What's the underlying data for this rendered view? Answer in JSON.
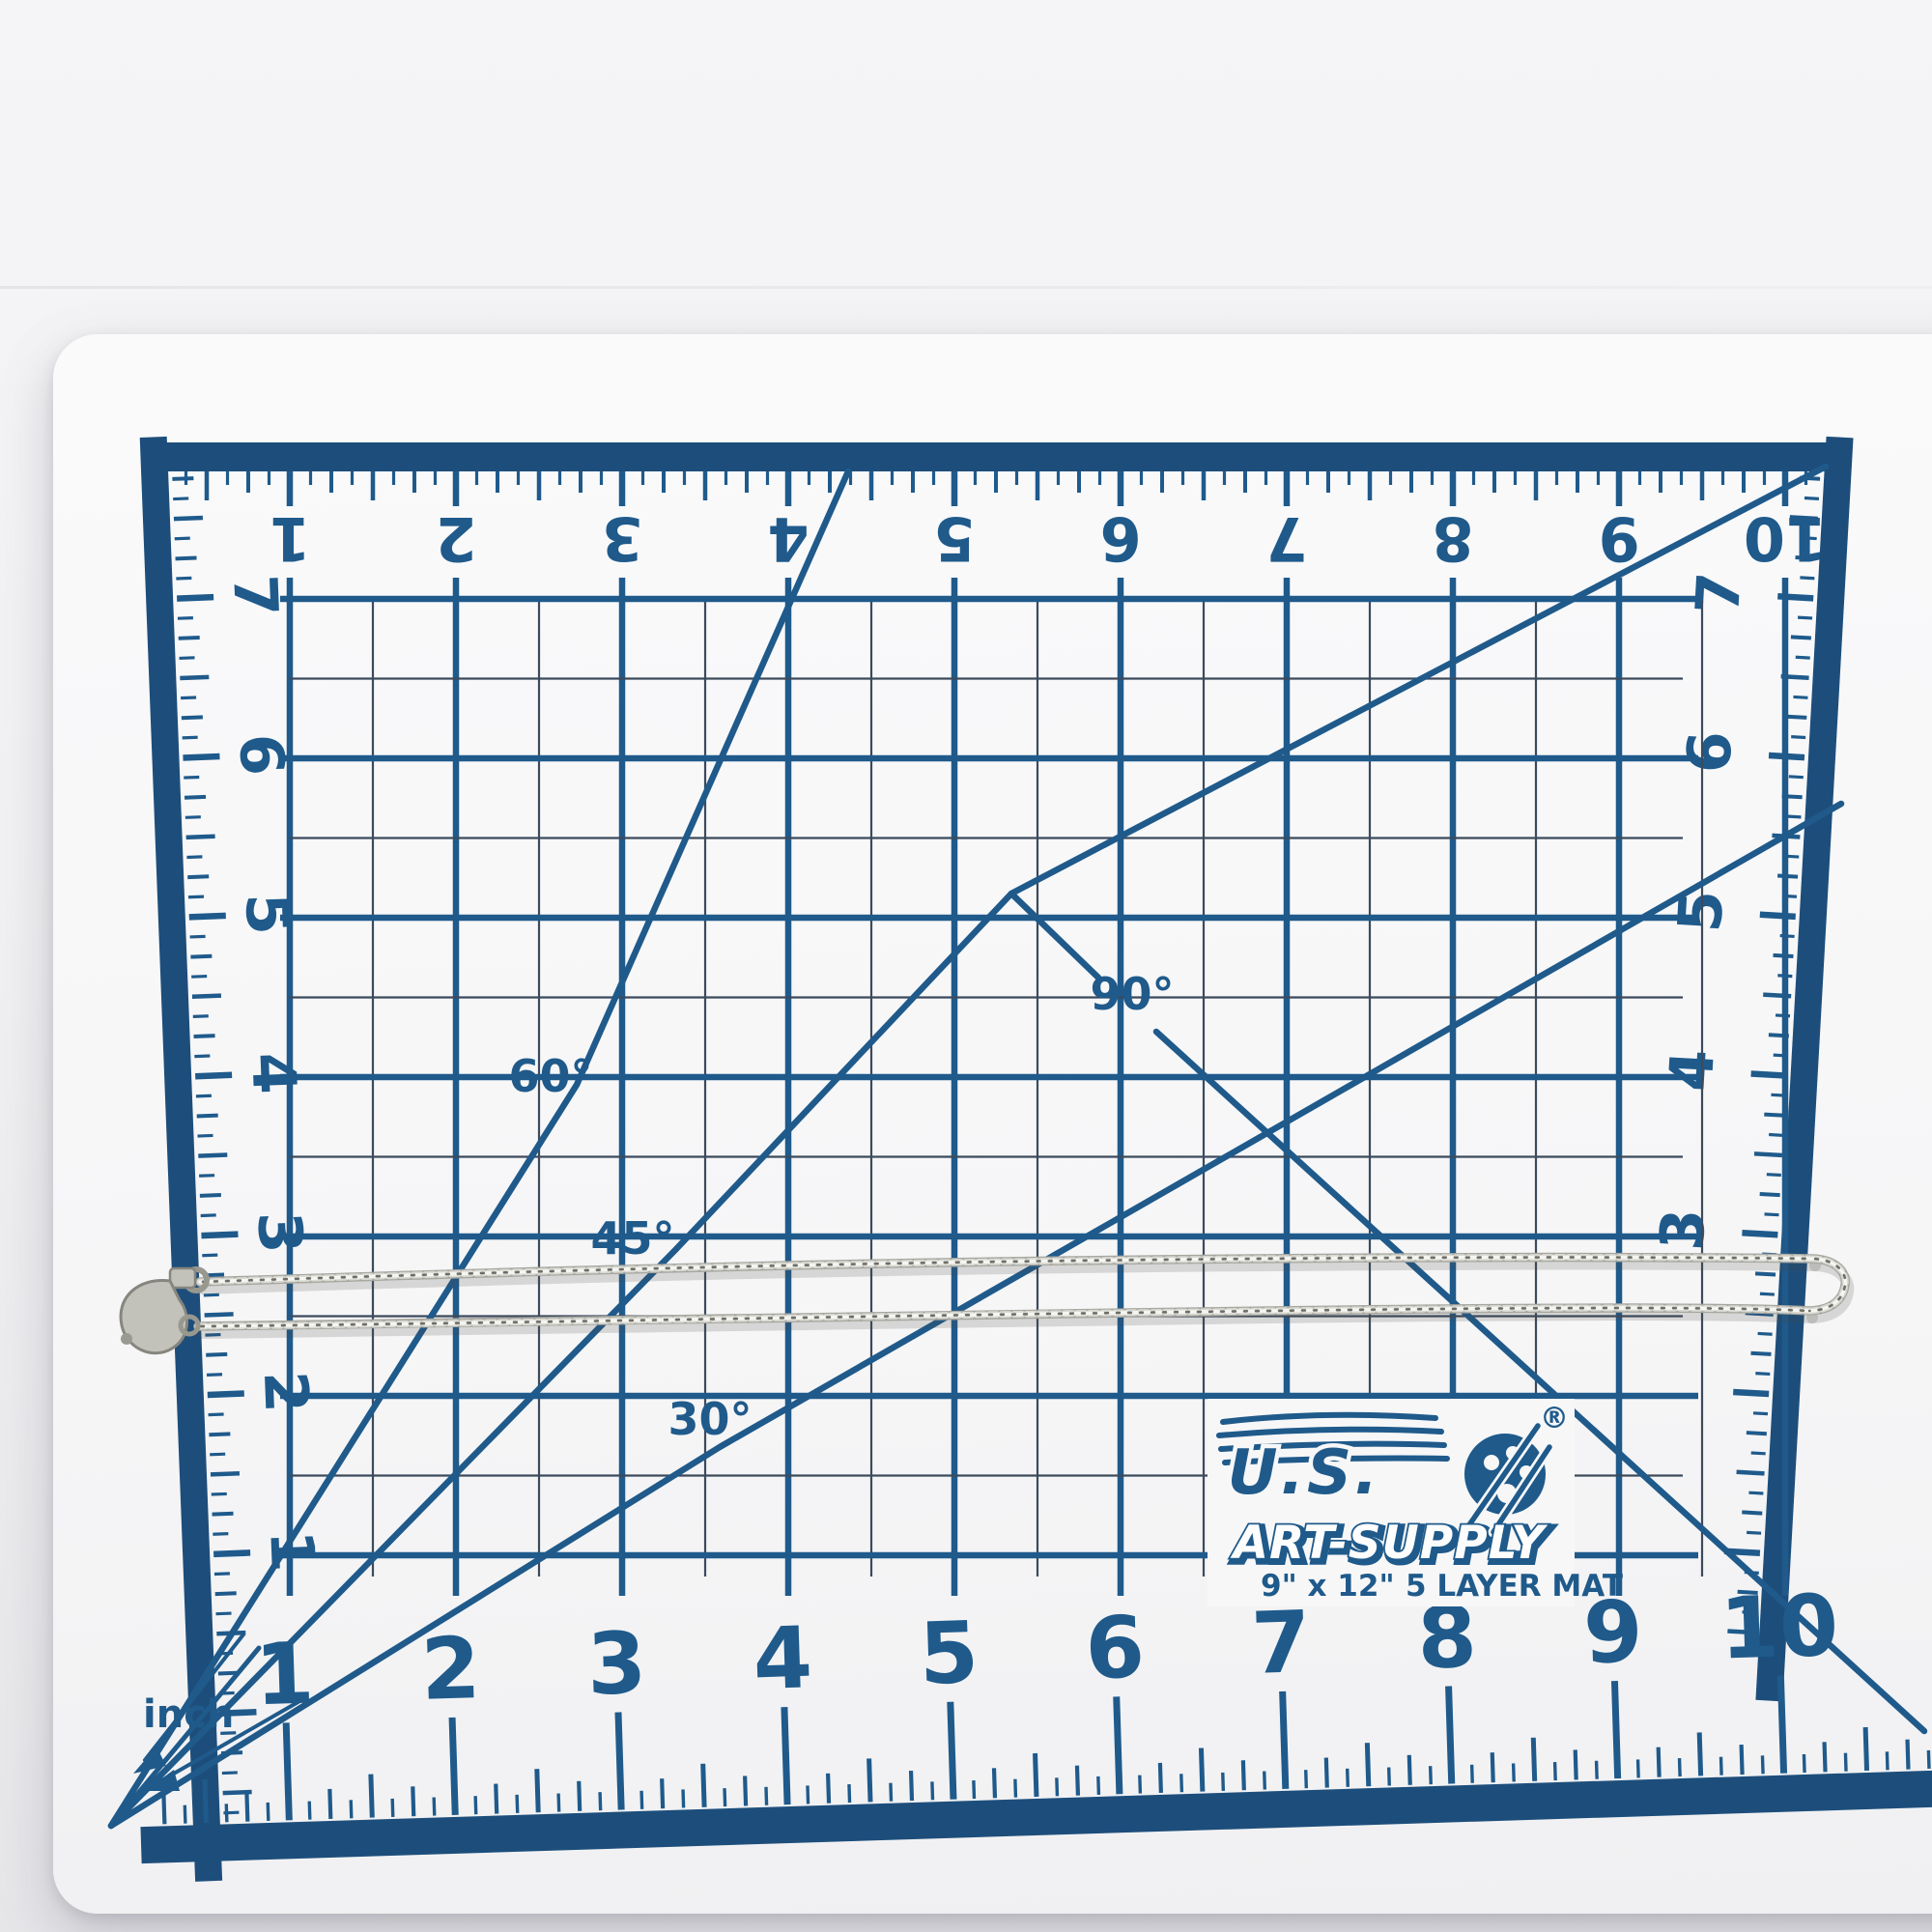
{
  "photo": {
    "backdrop_color": "#f1f1f3",
    "mat_surface_color": "#f7f7f8",
    "print_color": "#1f5a8b",
    "border_color": "#1d4e7b",
    "fine_line_color": "#3c4a5c"
  },
  "mat": {
    "unit_label": "inch",
    "angle_labels": [
      "90°",
      "60°",
      "45°",
      "30°"
    ],
    "ruler_numbers": {
      "top": [
        "1",
        "2",
        "3",
        "4",
        "5",
        "6",
        "7",
        "8",
        "9",
        "10"
      ],
      "bottom": [
        "1",
        "2",
        "3",
        "4",
        "5",
        "6",
        "7",
        "8",
        "9",
        "10"
      ],
      "left": [
        "7",
        "6",
        "5",
        "4",
        "3",
        "2",
        "1"
      ],
      "right": [
        "7",
        "6",
        "5",
        "4",
        "3"
      ]
    },
    "logo": {
      "brand_top": "U.S.",
      "brand_bottom": "ART-SUPPLY",
      "registered": "®",
      "size": "9\" x 12\"",
      "layers": "5 LAYER MAT"
    }
  },
  "chain": {
    "color_shadow": "rgba(70,70,64,0.18)",
    "color_base": "#a7a7a0",
    "color_mid": "#d9d9d3",
    "color_highlight": "#f5f5f1",
    "color_dark": "#6e6e66",
    "clasp_fill": "#c2c2bb",
    "clasp_edge": "#86867e"
  }
}
